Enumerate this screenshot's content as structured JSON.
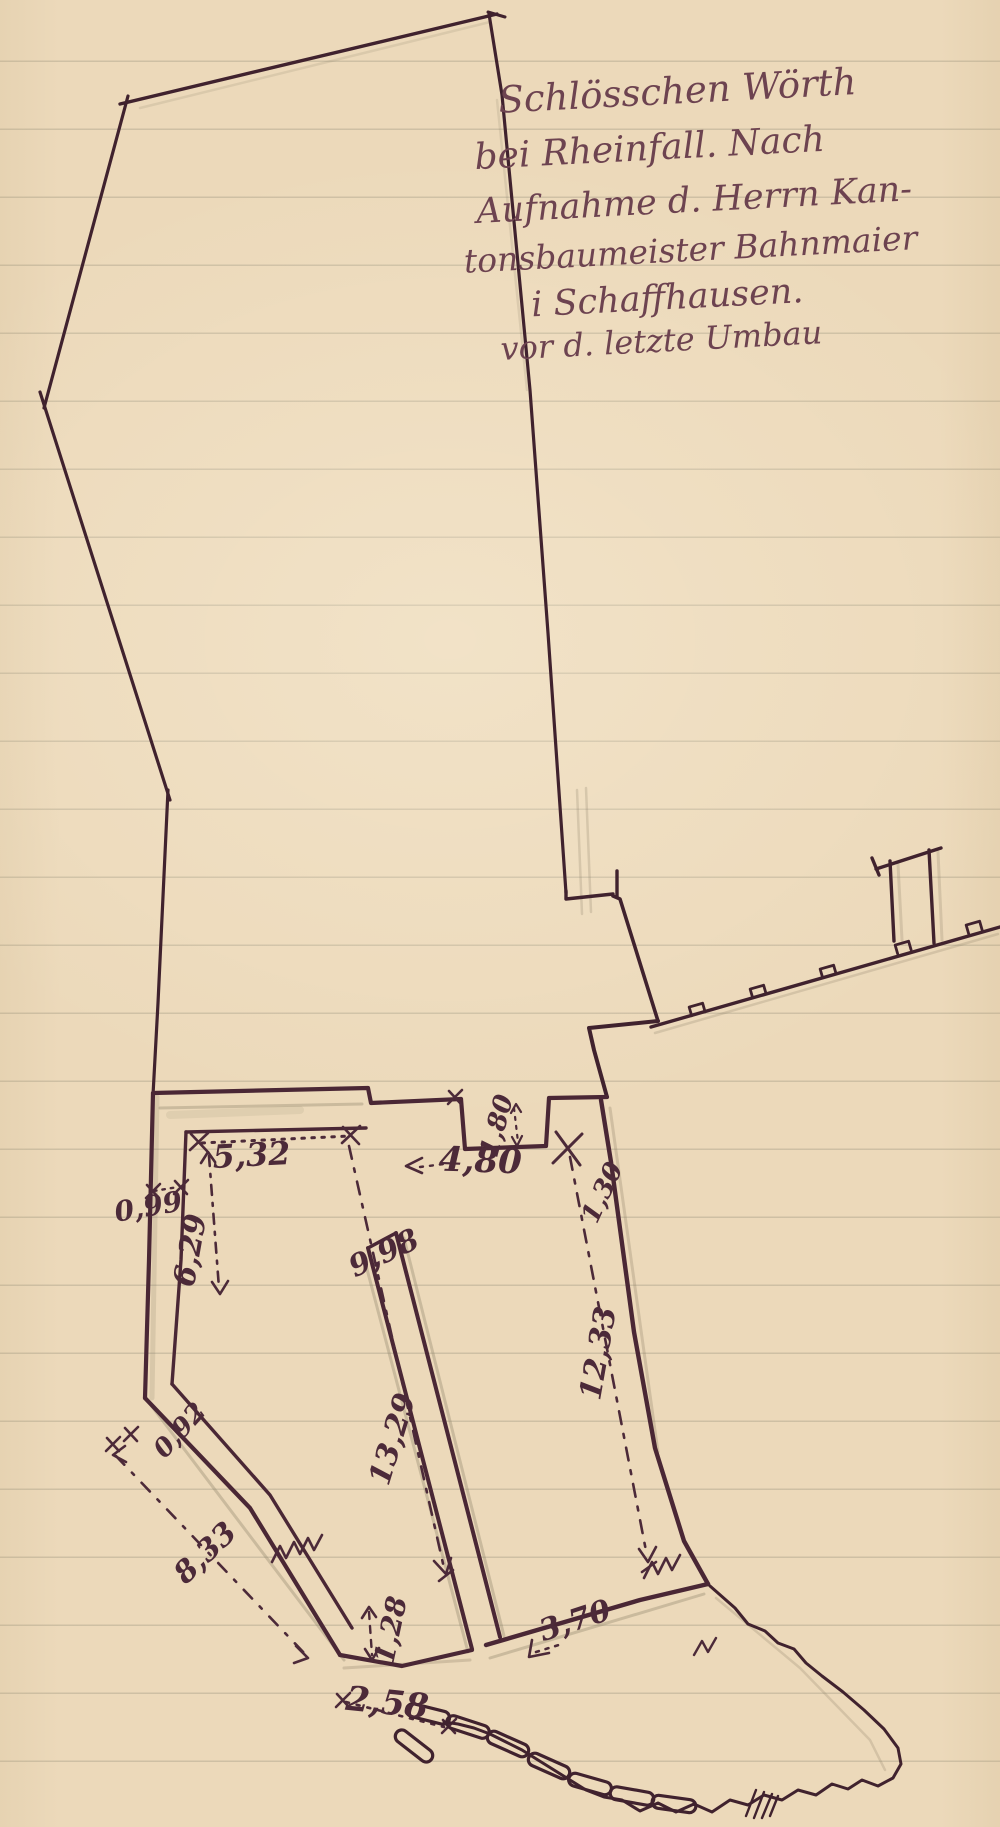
{
  "document": {
    "kind": "hand-drawn survey sketch on ruled paper",
    "title_lines": [
      "Schlösschen Wörth",
      "bei Rheinfall. Nach",
      "Aufnahme d. Herrn Kan-",
      "tonsbaumeister Bahnmaier",
      "i Schaffhausen.",
      "vor d. letzte Umbau"
    ]
  },
  "measurements": [
    {
      "name": "top-inner-width",
      "text": "5,32"
    },
    {
      "name": "top-right-width",
      "text": "4,80"
    },
    {
      "name": "niche-depth",
      "text": "1,80"
    },
    {
      "name": "left-wall-thickness",
      "text": "0,99"
    },
    {
      "name": "left-inner-length",
      "text": "6,29"
    },
    {
      "name": "strip-upper-length",
      "text": "9,98"
    },
    {
      "name": "right-upper-length",
      "text": "1,30"
    },
    {
      "name": "right-inner-length",
      "text": "12,33"
    },
    {
      "name": "middle-length",
      "text": "13,29"
    },
    {
      "name": "sw-wall-thickness",
      "text": "0,92"
    },
    {
      "name": "sw-outer-length",
      "text": "8,33"
    },
    {
      "name": "bottom-left-jog",
      "text": "1,28"
    },
    {
      "name": "bottom-right-length",
      "text": "3,70"
    },
    {
      "name": "bottom-gap",
      "text": "2,58"
    }
  ],
  "colors": {
    "paper": "#ecd9ba",
    "ruling": "#948e78",
    "ink_outline": "#40222e",
    "ink_building": "#4a2735",
    "ink_measure": "#4c2a39",
    "ink_handwriting": "#6d4350",
    "pencil": "#8d8168"
  }
}
